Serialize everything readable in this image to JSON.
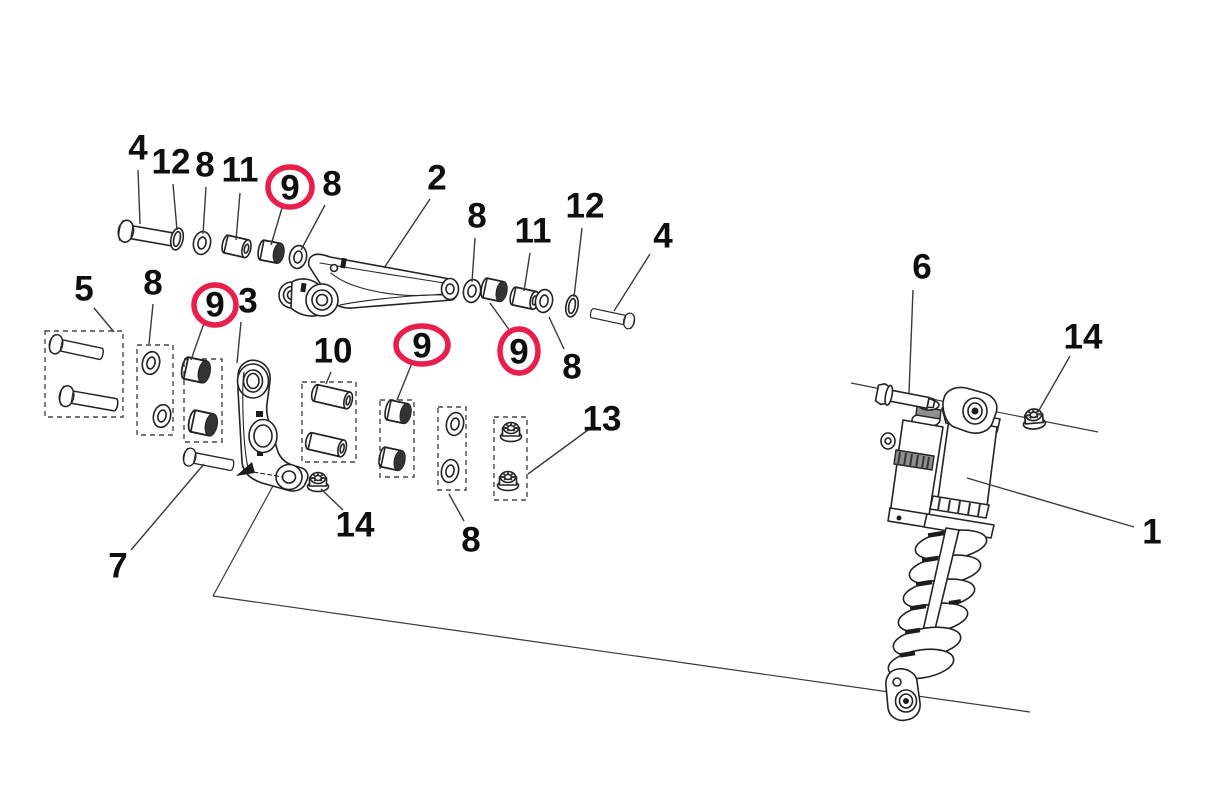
{
  "diagram": {
    "name": "rear-shock-linkage-exploded-parts-diagram",
    "background": "#ffffff",
    "ink_color": "#232323",
    "leader_color": "#3a3a3a",
    "highlight_color": "#e91e4a",
    "canvas": {
      "width": 1211,
      "height": 802
    }
  },
  "callouts": [
    {
      "part": "4",
      "x": 138,
      "y": 148,
      "leader": [
        138,
        170,
        140,
        224
      ],
      "circled": false
    },
    {
      "part": "12",
      "x": 171,
      "y": 162,
      "leader": [
        173,
        184,
        177,
        230
      ],
      "circled": false
    },
    {
      "part": "8",
      "x": 205,
      "y": 165,
      "leader": [
        206,
        187,
        203,
        234
      ],
      "circled": false
    },
    {
      "part": "11",
      "x": 240,
      "y": 170,
      "leader": [
        240,
        193,
        236,
        240
      ],
      "circled": false
    },
    {
      "part": "9",
      "x": 290,
      "y": 188,
      "leader": [
        282,
        208,
        271,
        245
      ],
      "circled": true,
      "circle": {
        "cx": 290,
        "cy": 187,
        "rx": 22,
        "ry": 20
      }
    },
    {
      "part": "8",
      "x": 332,
      "y": 184,
      "leader": [
        325,
        205,
        301,
        250
      ],
      "circled": false
    },
    {
      "part": "2",
      "x": 437,
      "y": 178,
      "leader": [
        430,
        199,
        384,
        268
      ],
      "circled": false
    },
    {
      "part": "8",
      "x": 477,
      "y": 216,
      "leader": [
        475,
        238,
        472,
        282
      ],
      "circled": false
    },
    {
      "part": "11",
      "x": 533,
      "y": 231,
      "leader": [
        530,
        253,
        524,
        291
      ],
      "circled": false
    },
    {
      "part": "12",
      "x": 585,
      "y": 206,
      "leader": [
        582,
        228,
        574,
        297
      ],
      "circled": false
    },
    {
      "part": "4",
      "x": 663,
      "y": 236,
      "leader": [
        650,
        254,
        614,
        311
      ],
      "circled": false
    },
    {
      "part": "9",
      "x": 519,
      "y": 352,
      "leader": [
        510,
        331,
        490,
        303
      ],
      "circled": true,
      "circle": {
        "cx": 519,
        "cy": 351,
        "rx": 19,
        "ry": 22
      }
    },
    {
      "part": "8",
      "x": 572,
      "y": 367,
      "leader": [
        564,
        349,
        549,
        317
      ],
      "circled": false
    },
    {
      "part": "5",
      "x": 84,
      "y": 289,
      "leader": [
        94,
        308,
        114,
        332
      ],
      "circled": false
    },
    {
      "part": "8",
      "x": 153,
      "y": 283,
      "leader": [
        153,
        304,
        149,
        344
      ],
      "circled": false
    },
    {
      "part": "9",
      "x": 215,
      "y": 305,
      "leader": [
        204,
        323,
        191,
        360
      ],
      "circled": true,
      "circle": {
        "cx": 215,
        "cy": 305,
        "rx": 21,
        "ry": 20
      }
    },
    {
      "part": "3",
      "x": 248,
      "y": 301,
      "leader": [
        241,
        322,
        237,
        363
      ],
      "circled": false
    },
    {
      "part": "10",
      "x": 333,
      "y": 351,
      "leader": [
        331,
        372,
        326,
        384
      ],
      "circled": false
    },
    {
      "part": "9",
      "x": 422,
      "y": 346,
      "leader": [
        412,
        363,
        397,
        400
      ],
      "circled": true,
      "circle": {
        "cx": 422,
        "cy": 345,
        "rx": 26,
        "ry": 19
      }
    },
    {
      "part": "8",
      "x": 471,
      "y": 540,
      "leader": [
        464,
        521,
        449,
        494
      ],
      "circled": false
    },
    {
      "part": "13",
      "x": 602,
      "y": 419,
      "leader": [
        588,
        430,
        528,
        474
      ],
      "circled": false
    },
    {
      "part": "14",
      "x": 355,
      "y": 525,
      "leader": [
        343,
        510,
        321,
        489
      ],
      "circled": false
    },
    {
      "part": "7",
      "x": 118,
      "y": 566,
      "leader": [
        131,
        550,
        204,
        464
      ],
      "circled": false
    },
    {
      "part": "6",
      "x": 922,
      "y": 267,
      "leader": [
        913,
        290,
        909,
        393
      ],
      "circled": false
    },
    {
      "part": "14",
      "x": 1083,
      "y": 337,
      "leader": [
        1070,
        356,
        1038,
        412
      ],
      "circled": false
    },
    {
      "part": "1",
      "x": 1152,
      "y": 532,
      "leader": [
        1134,
        527,
        967,
        478
      ],
      "circled": false
    }
  ],
  "reference_lines": [
    {
      "name": "upper-shock-mount-axis-line",
      "points": [
        851,
        383,
        1098,
        432
      ]
    },
    {
      "name": "linkage-axis-line-left",
      "points": [
        280,
        473,
        213,
        596
      ]
    },
    {
      "name": "linkage-axis-line-right",
      "points": [
        213,
        596,
        1030,
        712
      ]
    }
  ]
}
